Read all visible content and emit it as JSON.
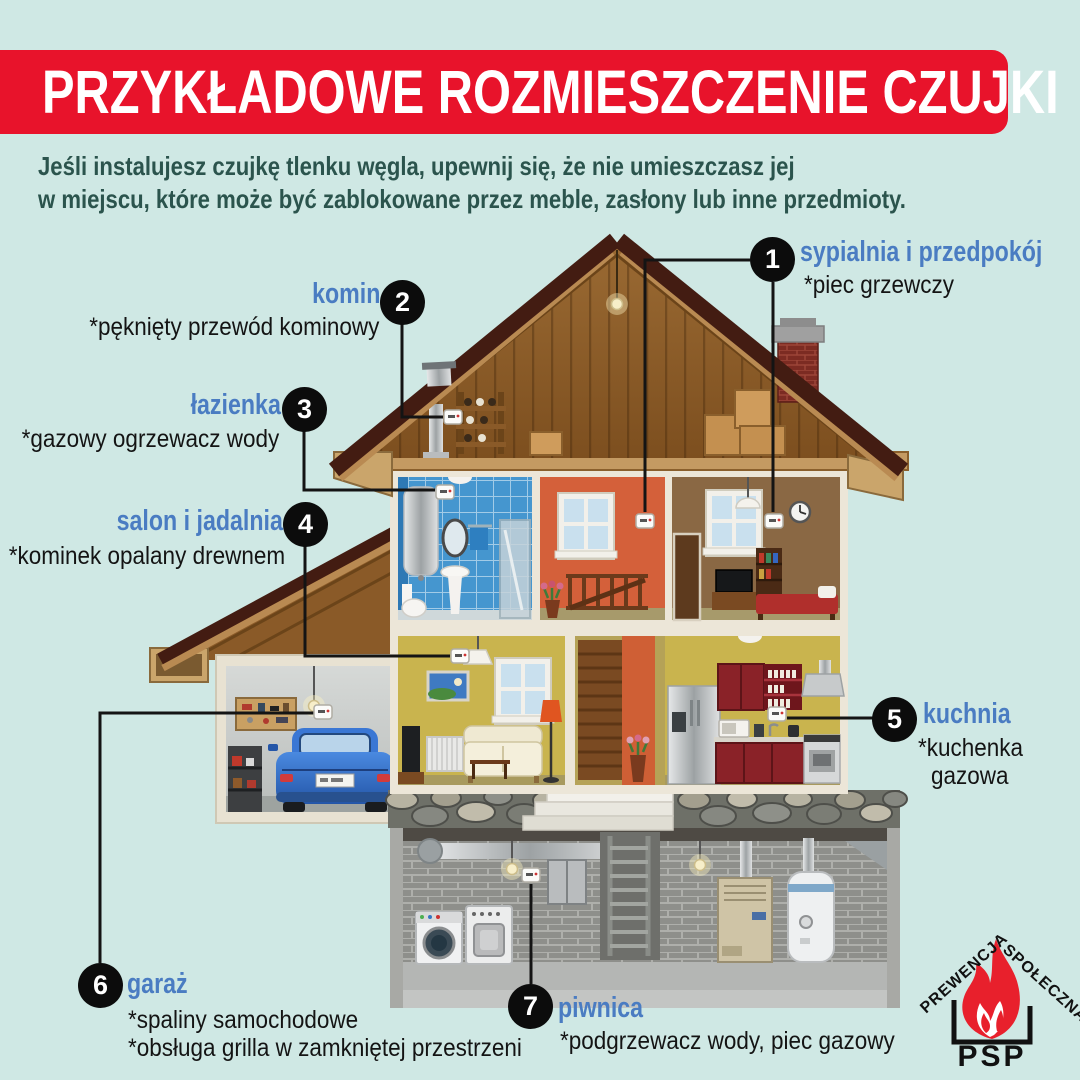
{
  "header": {
    "title": "PRZYKŁADOWE ROZMIESZCZENIE CZUJKI"
  },
  "intro": {
    "line1": "Jeśli instalujesz czujkę tlenku węgla, upewnij się, że nie umieszczasz jej",
    "line2": "w miejscu, które może być zablokowane przez meble, zasłony lub inne przedmioty."
  },
  "labels": [
    {
      "num": "1",
      "title": "sypialnia i przedpokój",
      "notes": [
        "*piec grzewczy"
      ]
    },
    {
      "num": "2",
      "title": "komin",
      "notes": [
        "*pęknięty przewód kominowy"
      ]
    },
    {
      "num": "3",
      "title": "łazienka",
      "notes": [
        "*gazowy ogrzewacz wody"
      ]
    },
    {
      "num": "4",
      "title": "salon i jadalnia",
      "notes": [
        "*kominek opalany drewnem"
      ]
    },
    {
      "num": "5",
      "title": "kuchnia",
      "notes": [
        "*kuchenka",
        "gazowa"
      ]
    },
    {
      "num": "6",
      "title": "garaż",
      "notes": [
        "*spaliny samochodowe",
        "*obsługa grilla w zamkniętej przestrzeni"
      ]
    },
    {
      "num": "7",
      "title": "piwnica",
      "notes": [
        "*podgrzewacz wody, piec gazowy"
      ]
    }
  ],
  "logo": {
    "word1": "PREWENCJA",
    "word2": "SPOŁECZNA",
    "abbr": "PSP"
  },
  "colors": {
    "background": "#cfe8e4",
    "banner_red": "#e8132b",
    "label_blue": "#4a7cc2",
    "intro_text": "#2b544d",
    "circle_black": "#0c0c0c",
    "flame_red": "#e8202c"
  }
}
